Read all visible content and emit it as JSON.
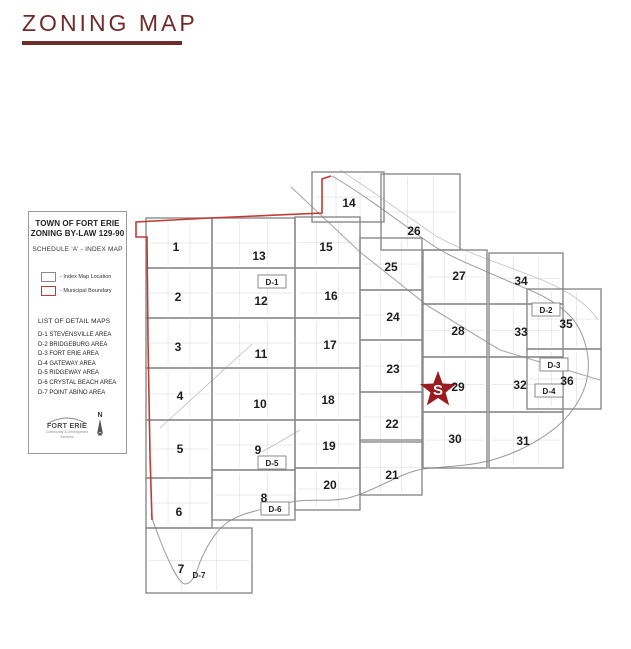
{
  "page": {
    "title": "ZONING MAP",
    "accent_color": "#702b2b"
  },
  "panel": {
    "title_line1": "TOWN OF FORT ERIE",
    "title_line2": "ZONING BY-LAW 129-90",
    "subtitle": "SCHEDULE 'A' - INDEX MAP",
    "legend": [
      {
        "label": "- Index Map Location",
        "box_color": "#8a8a8a"
      },
      {
        "label": "- Municipal Boundary",
        "box_color": "#c23b33"
      }
    ],
    "detail_maps_title": "LIST OF DETAIL MAPS",
    "detail_maps": [
      "D-1 STEVENSVILLE AREA",
      "D-2 BRIDGEBURG AREA",
      "D-3 FORT ERIE AREA",
      "D-4 GATEWAY AREA",
      "D-5 RIDGEWAY AREA",
      "D-6 CRYSTAL BEACH AREA",
      "D-7 POINT ABINO AREA"
    ],
    "logo_text": "FORT ERIE",
    "logo_tagline1": "Community & Development",
    "logo_tagline2": "Services",
    "north_label": "N"
  },
  "map": {
    "grid_color": "#8a8a8a",
    "boundary_color": "#c23b33",
    "street_color": "#d6d6d6",
    "star": {
      "label": "S",
      "color": "#9b1b20",
      "x": 438,
      "y": 390,
      "outer_r": 19,
      "inner_r": 8
    },
    "tiles": [
      {
        "n": "1",
        "x": 146,
        "y": 218,
        "w": 66,
        "h": 50,
        "lx": 176,
        "ly": 247
      },
      {
        "n": "2",
        "x": 146,
        "y": 268,
        "w": 66,
        "h": 50,
        "lx": 178,
        "ly": 297
      },
      {
        "n": "3",
        "x": 146,
        "y": 318,
        "w": 66,
        "h": 50,
        "lx": 178,
        "ly": 347
      },
      {
        "n": "4",
        "x": 146,
        "y": 368,
        "w": 66,
        "h": 52,
        "lx": 180,
        "ly": 396
      },
      {
        "n": "5",
        "x": 146,
        "y": 420,
        "w": 66,
        "h": 58,
        "lx": 180,
        "ly": 449
      },
      {
        "n": "6",
        "x": 146,
        "y": 478,
        "w": 66,
        "h": 50,
        "lx": 179,
        "ly": 512
      },
      {
        "n": "7",
        "x": 146,
        "y": 528,
        "w": 106,
        "h": 65,
        "lx": 181,
        "ly": 569
      },
      {
        "n": "8",
        "x": 212,
        "y": 470,
        "w": 83,
        "h": 50,
        "lx": 264,
        "ly": 498
      },
      {
        "n": "9",
        "x": 212,
        "y": 420,
        "w": 83,
        "h": 50,
        "lx": 258,
        "ly": 450
      },
      {
        "n": "10",
        "x": 212,
        "y": 368,
        "w": 83,
        "h": 52,
        "lx": 260,
        "ly": 404
      },
      {
        "n": "11",
        "x": 212,
        "y": 318,
        "w": 83,
        "h": 50,
        "lx": 261,
        "ly": 354
      },
      {
        "n": "12",
        "x": 212,
        "y": 268,
        "w": 83,
        "h": 50,
        "lx": 261,
        "ly": 301
      },
      {
        "n": "13",
        "x": 212,
        "y": 218,
        "w": 83,
        "h": 50,
        "lx": 259,
        "ly": 256
      },
      {
        "n": "14",
        "x": 312,
        "y": 172,
        "w": 72,
        "h": 50,
        "lx": 349,
        "ly": 203
      },
      {
        "n": "15",
        "x": 295,
        "y": 217,
        "w": 65,
        "h": 51,
        "lx": 326,
        "ly": 247
      },
      {
        "n": "16",
        "x": 295,
        "y": 268,
        "w": 65,
        "h": 50,
        "lx": 331,
        "ly": 296
      },
      {
        "n": "17",
        "x": 295,
        "y": 318,
        "w": 65,
        "h": 50,
        "lx": 330,
        "ly": 345
      },
      {
        "n": "18",
        "x": 295,
        "y": 368,
        "w": 65,
        "h": 52,
        "lx": 328,
        "ly": 400
      },
      {
        "n": "19",
        "x": 295,
        "y": 420,
        "w": 65,
        "h": 48,
        "lx": 329,
        "ly": 446
      },
      {
        "n": "20",
        "x": 295,
        "y": 468,
        "w": 65,
        "h": 42,
        "lx": 330,
        "ly": 485
      },
      {
        "n": "21",
        "x": 360,
        "y": 440,
        "w": 62,
        "h": 55,
        "lx": 392,
        "ly": 475
      },
      {
        "n": "22",
        "x": 360,
        "y": 392,
        "w": 62,
        "h": 50,
        "lx": 392,
        "ly": 424
      },
      {
        "n": "23",
        "x": 360,
        "y": 340,
        "w": 62,
        "h": 52,
        "lx": 393,
        "ly": 369
      },
      {
        "n": "24",
        "x": 360,
        "y": 290,
        "w": 62,
        "h": 50,
        "lx": 393,
        "ly": 317
      },
      {
        "n": "25",
        "x": 360,
        "y": 238,
        "w": 62,
        "h": 52,
        "lx": 391,
        "ly": 267
      },
      {
        "n": "26",
        "x": 381,
        "y": 174,
        "w": 79,
        "h": 76,
        "lx": 414,
        "ly": 231
      },
      {
        "n": "27",
        "x": 423,
        "y": 250,
        "w": 64,
        "h": 54,
        "lx": 459,
        "ly": 276
      },
      {
        "n": "28",
        "x": 423,
        "y": 304,
        "w": 64,
        "h": 53,
        "lx": 458,
        "ly": 331
      },
      {
        "n": "29",
        "x": 423,
        "y": 357,
        "w": 64,
        "h": 55,
        "lx": 458,
        "ly": 387
      },
      {
        "n": "30",
        "x": 423,
        "y": 412,
        "w": 64,
        "h": 56,
        "lx": 455,
        "ly": 439
      },
      {
        "n": "31",
        "x": 489,
        "y": 412,
        "w": 74,
        "h": 56,
        "lx": 523,
        "ly": 441
      },
      {
        "n": "32",
        "x": 489,
        "y": 357,
        "w": 74,
        "h": 55,
        "lx": 520,
        "ly": 385
      },
      {
        "n": "33",
        "x": 489,
        "y": 304,
        "w": 74,
        "h": 53,
        "lx": 521,
        "ly": 332
      },
      {
        "n": "34",
        "x": 489,
        "y": 253,
        "w": 74,
        "h": 51,
        "lx": 521,
        "ly": 281
      },
      {
        "n": "35",
        "x": 527,
        "y": 289,
        "w": 74,
        "h": 60,
        "lx": 566,
        "ly": 324
      },
      {
        "n": "36",
        "x": 527,
        "y": 349,
        "w": 74,
        "h": 60,
        "lx": 567,
        "ly": 381
      }
    ],
    "area_labels": [
      {
        "t": "D-1",
        "x": 272,
        "y": 282,
        "boxed": true
      },
      {
        "t": "D-2",
        "x": 546,
        "y": 310,
        "boxed": true
      },
      {
        "t": "D-3",
        "x": 554,
        "y": 365,
        "boxed": true
      },
      {
        "t": "D-4",
        "x": 549,
        "y": 391,
        "boxed": true
      },
      {
        "t": "D-5",
        "x": 272,
        "y": 463,
        "boxed": true
      },
      {
        "t": "D-6",
        "x": 275,
        "y": 509,
        "boxed": true
      },
      {
        "t": "D-7",
        "x": 199,
        "y": 575,
        "boxed": false
      }
    ]
  }
}
